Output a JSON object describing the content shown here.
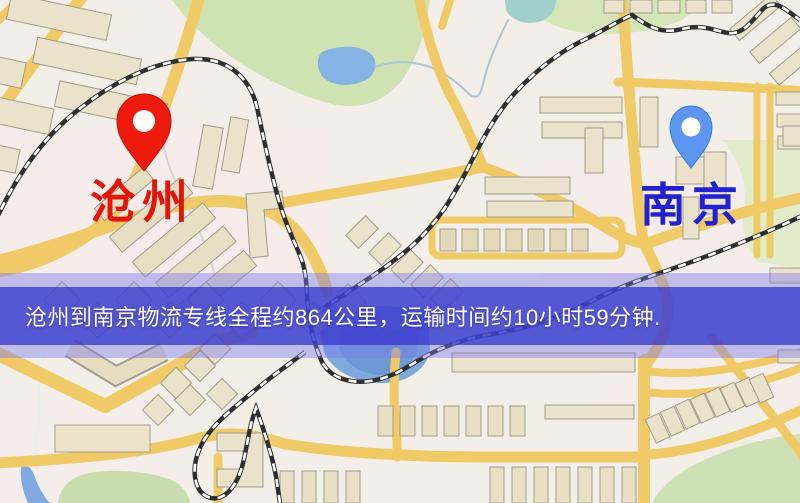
{
  "banner": {
    "text": "沧州到南京物流专线全程约864公里，运输时间约10小时59分钟."
  },
  "markers": {
    "origin": {
      "label": "沧州",
      "pin_color": "#ee1a0c"
    },
    "destination": {
      "label": "南京",
      "pin_color": "#5d96f0"
    }
  },
  "route": {
    "distance_km": "864",
    "duration": "10小时59分钟"
  },
  "colors": {
    "background": "#f3efe8",
    "road": "#f0ca66",
    "park": "#cfe3b2",
    "water": "#85b4e4",
    "building": "#eae2cb",
    "railway": "#2f2f2f",
    "banner_band": "rgba(56,58,204,.78)",
    "banner_glow": "rgba(118,120,235,.42)",
    "origin_label": "#e61408",
    "destination_label": "#2121d0"
  }
}
